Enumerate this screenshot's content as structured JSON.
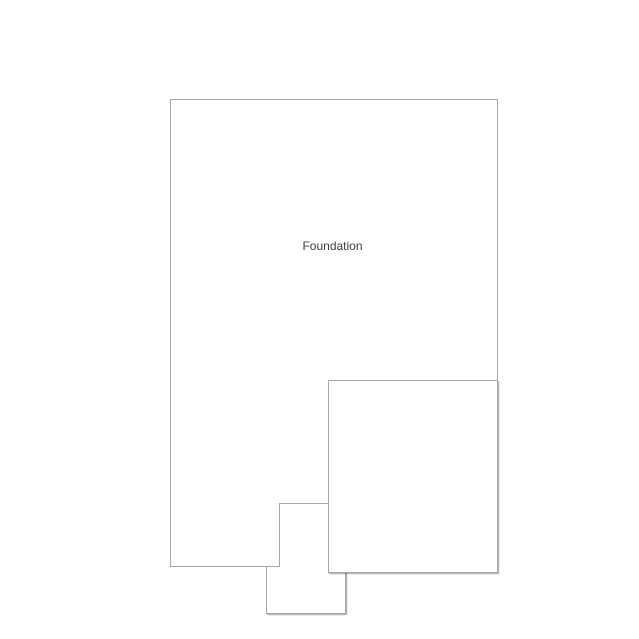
{
  "diagram": {
    "label": "Foundation"
  },
  "colors": {
    "background": "#ffffff",
    "shape_fill": "#ffffff",
    "stroke": "#a8a8a8",
    "text": "#3f3f3f"
  }
}
